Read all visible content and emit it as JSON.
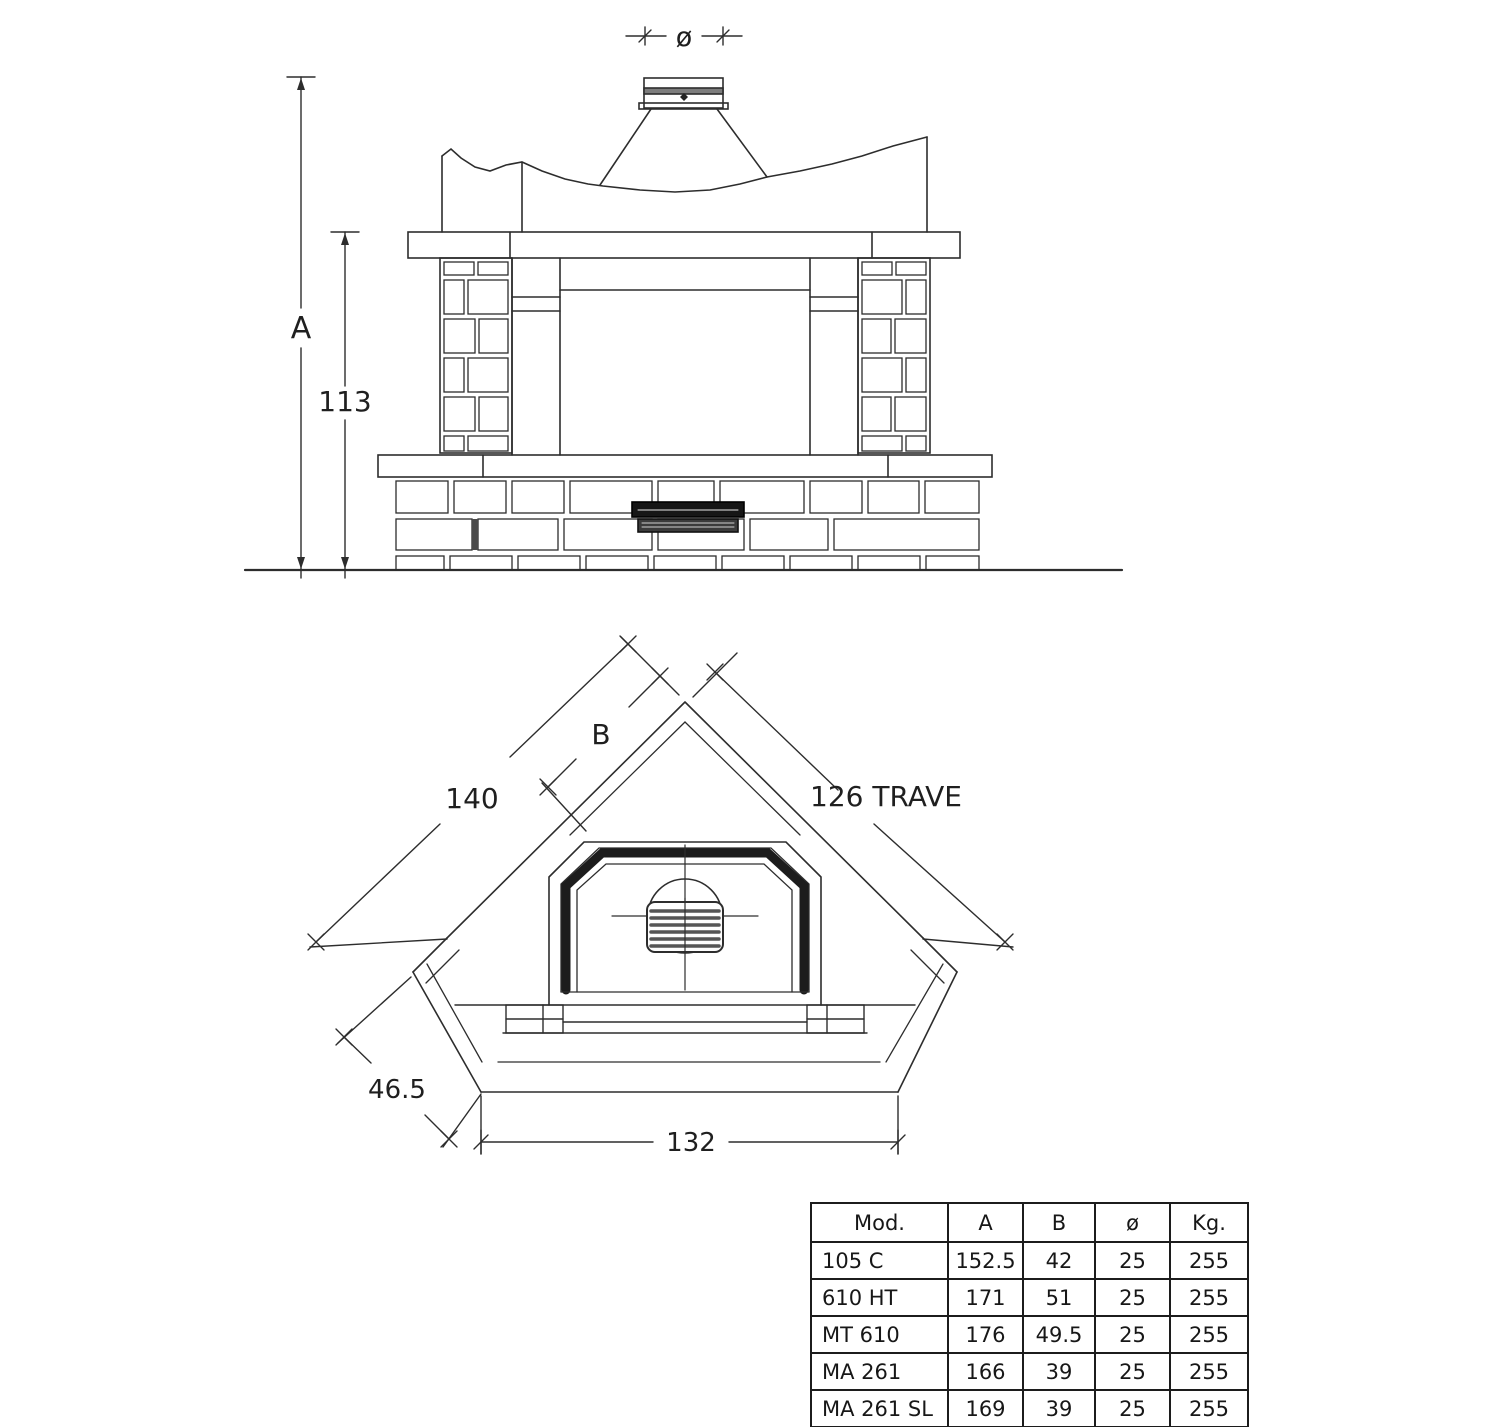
{
  "front_view": {
    "dim_a": "A",
    "dim_113": "113",
    "dim_dia": "ø"
  },
  "plan_view": {
    "dim_140": "140",
    "dim_b": "B",
    "dim_126": "126 TRAVE",
    "dim_46_5": "46.5",
    "dim_132": "132"
  },
  "spec_table": {
    "headers": [
      "Mod.",
      "A",
      "B",
      "ø",
      "Kg."
    ],
    "rows": [
      [
        "105 C",
        "152.5",
        "42",
        "25",
        "255"
      ],
      [
        "610 HT",
        "171",
        "51",
        "25",
        "255"
      ],
      [
        "MT 610",
        "176",
        "49.5",
        "25",
        "255"
      ],
      [
        "MA 261",
        "166",
        "39",
        "25",
        "255"
      ],
      [
        "MA 261 SL",
        "169",
        "39",
        "25",
        "255"
      ],
      [
        "HT 361",
        "171",
        "44.5",
        "25",
        "255"
      ]
    ]
  }
}
